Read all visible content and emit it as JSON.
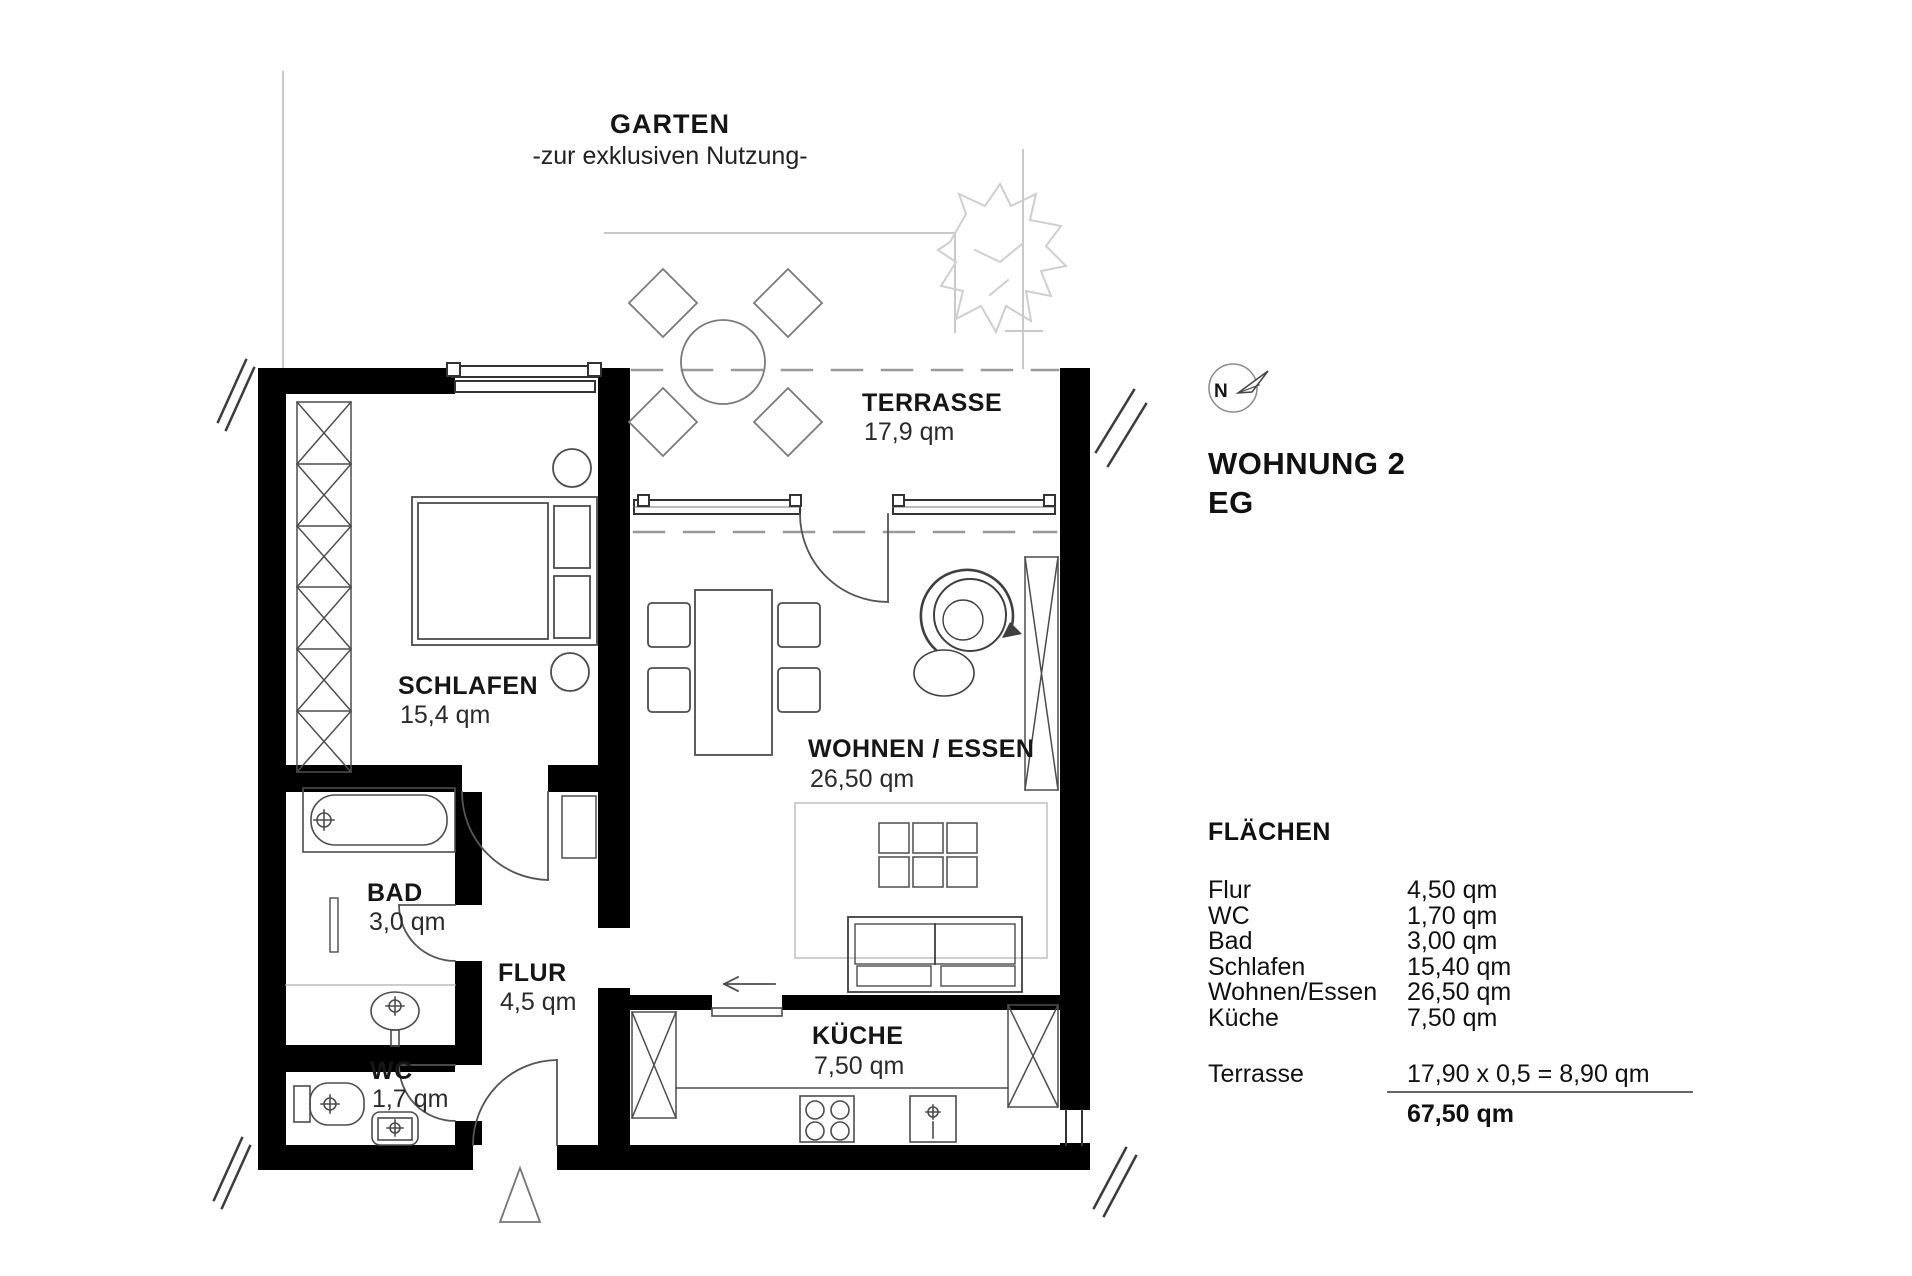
{
  "garden": {
    "name": "GARTEN",
    "subtitle": "-zur exklusiven Nutzung-"
  },
  "rooms": {
    "terrasse": {
      "name": "TERRASSE",
      "area": "17,9 qm"
    },
    "schlafen": {
      "name": "SCHLAFEN",
      "area": "15,4 qm"
    },
    "wohnen_essen": {
      "name": "WOHNEN / ESSEN",
      "area": "26,50 qm"
    },
    "bad": {
      "name": "BAD",
      "area": "3,0 qm"
    },
    "flur": {
      "name": "FLUR",
      "area": "4,5 qm"
    },
    "wc": {
      "name": "WC",
      "area": "1,7 qm"
    },
    "kueche": {
      "name": "KÜCHE",
      "area": "7,50 qm"
    }
  },
  "compass": {
    "north_label": "N"
  },
  "unit": {
    "title": "WOHNUNG 2",
    "floor": "EG"
  },
  "areas_table": {
    "heading": "FLÄCHEN",
    "rows": [
      {
        "label": "Flur",
        "value": "4,50 qm"
      },
      {
        "label": "WC",
        "value": "1,70 qm"
      },
      {
        "label": "Bad",
        "value": "3,00 qm"
      },
      {
        "label": "Schlafen",
        "value": "15,40 qm"
      },
      {
        "label": "Wohnen/Essen",
        "value": "26,50 qm"
      },
      {
        "label": "Küche",
        "value": "7,50 qm"
      }
    ],
    "terrace_row": {
      "label": "Terrasse",
      "value": "17,90 x 0,5 = 8,90 qm"
    },
    "total": {
      "value": "67,50 qm"
    }
  },
  "colors": {
    "wall": "#000000",
    "furniture_line": "#4d4d4d",
    "garden_line": "#c9c9c9",
    "dash_line": "#9a9a9a",
    "text": "#161616"
  }
}
